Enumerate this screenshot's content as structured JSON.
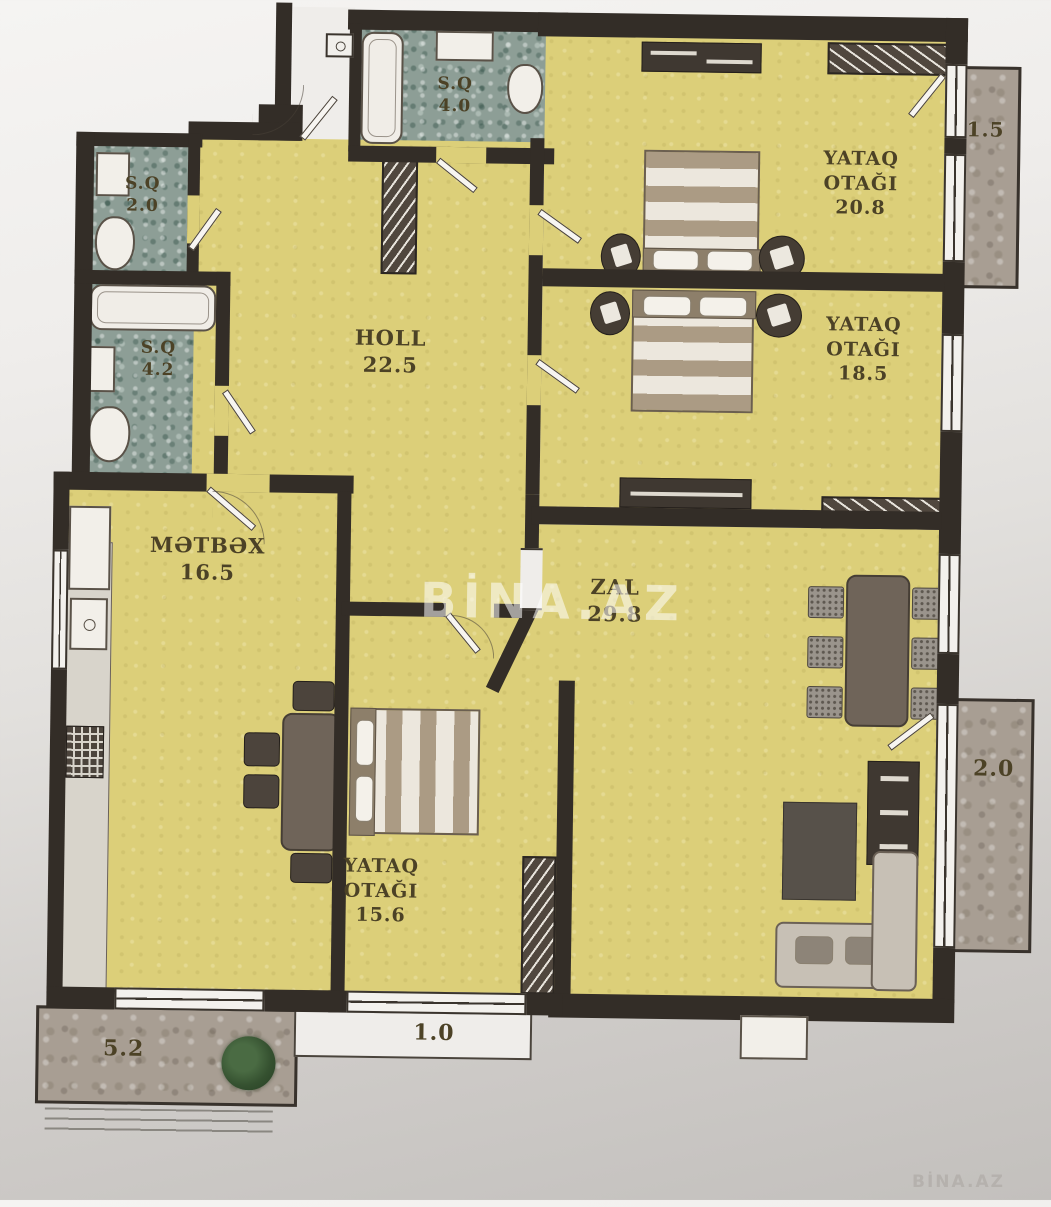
{
  "plan": {
    "watermark_center": "BİNA.AZ",
    "watermark_corner": "BİNA.AZ",
    "rooms": {
      "hall": {
        "name": "HOLL",
        "area": "22.5"
      },
      "kitchen": {
        "name": "MƏTBƏX",
        "area": "16.5"
      },
      "living": {
        "name": "ZAL",
        "area": "29.8"
      },
      "bedroom_top": {
        "name_l1": "YATAQ",
        "name_l2": "OTAĞI",
        "area": "20.8"
      },
      "bedroom_mid": {
        "name_l1": "YATAQ",
        "name_l2": "OTAĞI",
        "area": "18.5"
      },
      "bedroom_bottom": {
        "name_l1": "YATAQ",
        "name_l2": "OTAĞI",
        "area": "15.6"
      },
      "bath_top": {
        "name": "S.Q",
        "area": "4.0"
      },
      "bath_upper_left": {
        "name": "S.Q",
        "area": "2.0"
      },
      "bath_lower_left": {
        "name": "S.Q",
        "area": "4.2"
      }
    },
    "balconies": {
      "top_right": {
        "area": "1.5"
      },
      "right": {
        "area": "2.0"
      },
      "bottom_left": {
        "area": "5.2"
      },
      "bottom_center": {
        "area": "1.0"
      }
    },
    "colors": {
      "room_fill": "#dccf79",
      "wall": "#332d27",
      "bath_tile": "#8d9e96",
      "balcony_stone": "#a89e93",
      "label_text": "#4c4226"
    }
  }
}
